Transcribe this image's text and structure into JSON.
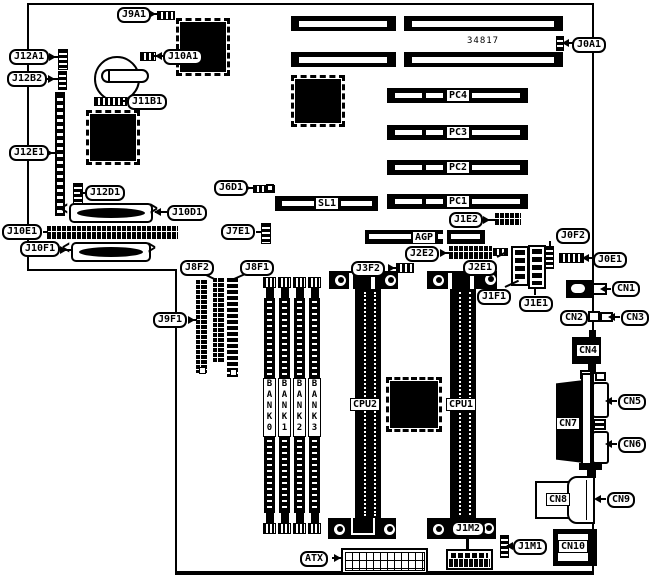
{
  "board": {
    "part_number": "34817"
  },
  "callouts": {
    "j9a1": "J9A1",
    "j0a1": "J0A1",
    "j12a1": "J12A1",
    "j12b2": "J12B2",
    "j10a1": "J10A1",
    "j11b1": "J11B1",
    "j12e1": "J12E1",
    "j12d1": "J12D1",
    "j6d1": "J6D1",
    "j10d1": "J10D1",
    "j10e1": "J10E1",
    "j7e1": "J7E1",
    "j10f1": "J10F1",
    "j8f2": "J8F2",
    "j8f1": "J8F1",
    "j9f1": "J9F1",
    "j1e2": "J1E2",
    "j2e2": "J2E2",
    "j3f2": "J3F2",
    "j2e1": "J2E1",
    "j0f2": "J0F2",
    "j0e1": "J0E1",
    "j1f1": "J1F1",
    "j1e1": "J1E1",
    "j1m1": "J1M1",
    "j1m2": "J1M2",
    "atx": "ATX",
    "cn1": "CN1",
    "cn2": "CN2",
    "cn3": "CN3",
    "cn4": "CN4",
    "cn5": "CN5",
    "cn6": "CN6",
    "cn7": "CN7",
    "cn8": "CN8",
    "cn9": "CN9",
    "cn10": "CN10"
  },
  "slots": {
    "pc1": "PC1",
    "pc2": "PC2",
    "pc3": "PC3",
    "pc4": "PC4",
    "sl1": "SL1",
    "agp": "AGP",
    "cpu1": "CPU1",
    "cpu2": "CPU2"
  },
  "memory_banks": [
    "BANK0",
    "BANK1",
    "BANK2",
    "BANK3"
  ]
}
